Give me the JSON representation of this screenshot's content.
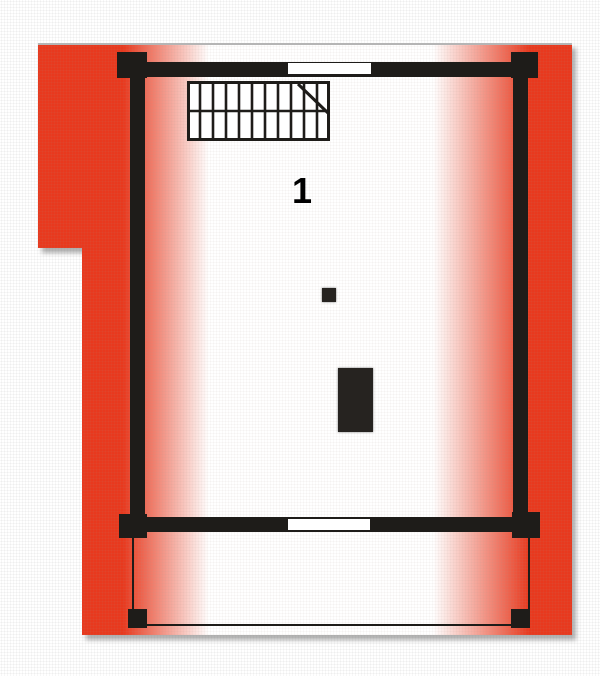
{
  "plan": {
    "room_label": "1"
  },
  "colors": {
    "roof_red": "#e8391e",
    "wall": "#1e1c19",
    "window_fill": "#ffffff",
    "top_edge_gray": "#b5b5b5"
  },
  "icons": {
    "staircase": "staircase-icon",
    "chimney": "chimney-marker",
    "stove": "stove-block"
  }
}
